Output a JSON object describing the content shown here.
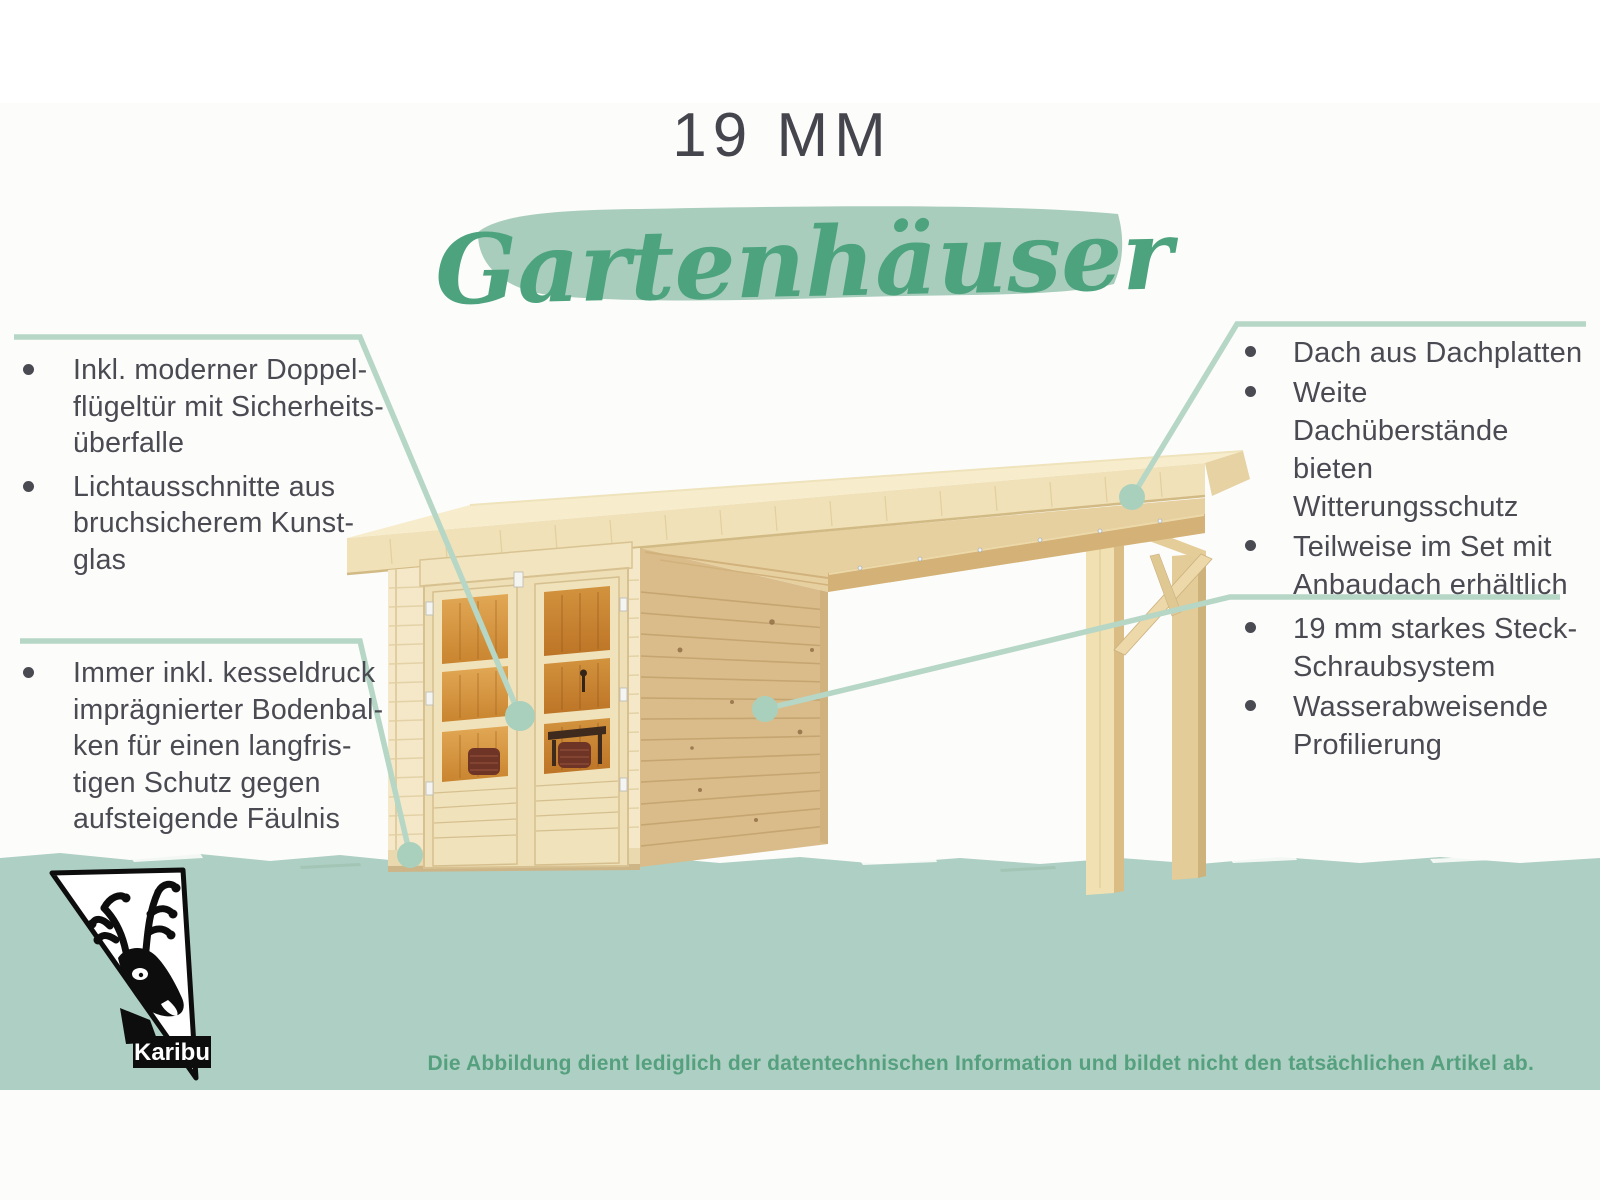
{
  "header": {
    "size_label": "19 MM",
    "category_label": "Gartenhäuser"
  },
  "callouts": {
    "door": {
      "position": "top-left",
      "items": [
        "Inkl. moderner Doppel-\nflügeltür mit Sicherheits-\nüberfalle",
        "Lichtausschnitte aus\nbruchsicherem Kunst-\nglas"
      ]
    },
    "floor": {
      "position": "bottom-left",
      "items": [
        "Immer inkl. kesseldruck\nimprägnierter Bodenbal-\nken für einen langfris-\ntigen Schutz gegen\naufsteigende Fäulnis"
      ]
    },
    "roof": {
      "position": "top-right",
      "items": [
        "Dach aus Dachplatten",
        "Weite Dachüberstände\nbieten Witterungsschutz",
        "Teilweise im Set mit\nAnbaudach erhältlich"
      ]
    },
    "wall": {
      "position": "middle-right",
      "items": [
        "19 mm starkes Steck-\nSchraubsystem",
        "Wasserabweisende\nProfilierung"
      ]
    }
  },
  "footer": {
    "disclaimer": "Die Abbildung dient lediglich der datentechnischen Information und bildet nicht den tatsächlichen Artikel ab."
  },
  "logo": {
    "brand": "Karibu",
    "icon": "deer-head-triangle"
  },
  "colors": {
    "title_text": "#45454d",
    "script_green": "#4da37d",
    "brush_green": "#a9cdbc",
    "connector_green": "#b6d6c6",
    "dot_green": "#a9d0bd",
    "ground_green": "#aecfc3",
    "body_text": "#4a4a52",
    "disclaimer_green": "#55a07e",
    "wood_light": "#f4e8c8",
    "wood_mid": "#e8d2a2",
    "wood_tan": "#d9bc8a",
    "interior_orange": "#cf9243"
  }
}
